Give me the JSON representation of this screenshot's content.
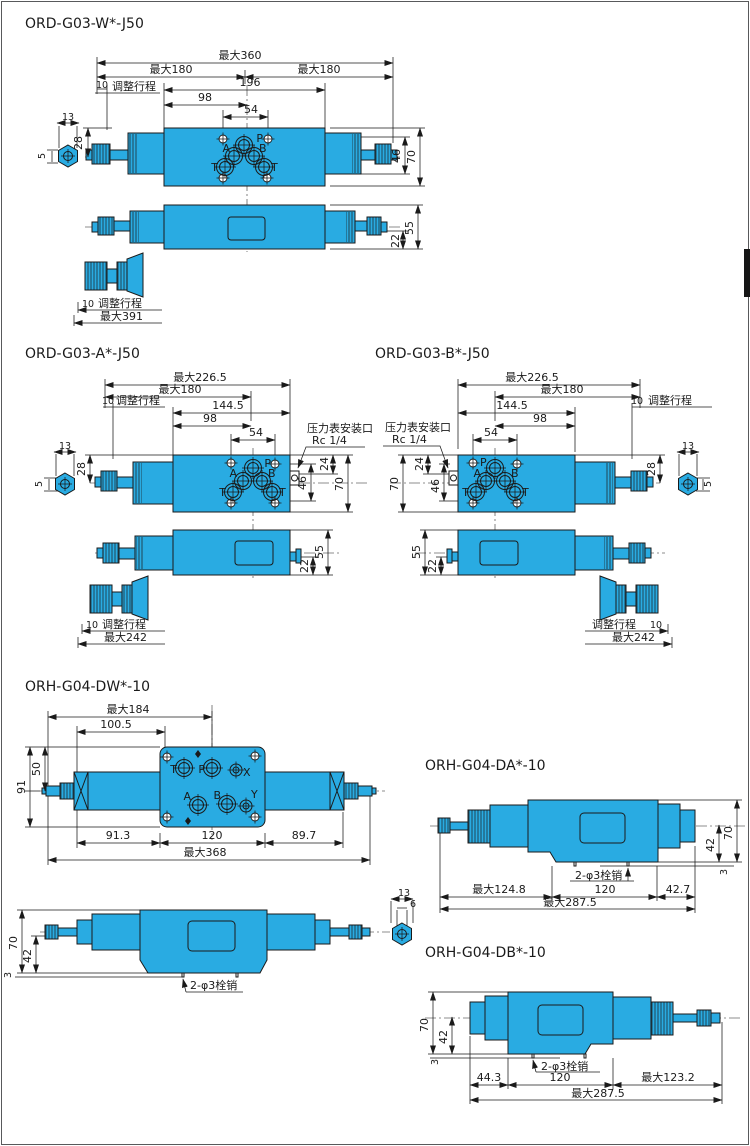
{
  "s1": {
    "title": "ORD-G03-W*-J50",
    "max360": "最大360",
    "max180l": "最大180",
    "max180r": "最大180",
    "d10": "10",
    "stroke": "调整行程",
    "d196": "196",
    "d98": "98",
    "d54": "54",
    "d13": "13",
    "d5": "5",
    "d28": "28",
    "d46": "46",
    "d70": "70",
    "d55": "55",
    "d22": "22",
    "p": "P",
    "a": "A",
    "b": "B",
    "t1": "T",
    "t2": "T",
    "k10": "10",
    "kstroke": "调整行程",
    "kmax": "最大391"
  },
  "s2": {
    "title": "ORD-G03-A*-J50",
    "max2265": "最大226.5",
    "max180": "最大180",
    "d10": "10",
    "stroke": "调整行程",
    "d1445": "144.5",
    "d98": "98",
    "d54": "54",
    "gauge1": "压力表安装口",
    "gauge2": "Rc 1/4",
    "d13": "13",
    "d5": "5",
    "d28": "28",
    "d24": "24",
    "d46": "46",
    "d70": "70",
    "d55": "55",
    "d22": "22",
    "p": "P",
    "a": "A",
    "b": "B",
    "t1": "T",
    "t2": "T",
    "k10": "10",
    "kstroke": "调整行程",
    "kmax": "最大242"
  },
  "s3": {
    "title": "ORD-G03-B*-J50",
    "max2265": "最大226.5",
    "max180": "最大180",
    "d10": "10",
    "stroke": "调整行程",
    "d1445": "144.5",
    "d98": "98",
    "d54": "54",
    "gauge1": "压力表安装口",
    "gauge2": "Rc 1/4",
    "d13": "13",
    "d5": "5",
    "d28": "28",
    "d24": "24",
    "d46": "46",
    "d70": "70",
    "d55": "55",
    "d22": "22",
    "p": "P",
    "a": "A",
    "b": "B",
    "t1": "T",
    "t2": "T",
    "k10": "10",
    "kstroke": "调整行程",
    "kmax": "最大242"
  },
  "s4": {
    "title": "ORH-G04-DW*-10",
    "max184": "最大184",
    "d1005": "100.5",
    "d91": "91",
    "d50": "50",
    "d913": "91.3",
    "d120": "120",
    "d897": "89.7",
    "max368": "最大368",
    "t": "T",
    "p": "P",
    "x": "X",
    "a": "A",
    "b": "B",
    "y": "Y",
    "d70": "70",
    "d42": "42",
    "d3": "3",
    "pins": "2-φ3栓销",
    "d13": "13",
    "d6": "6"
  },
  "s5": {
    "title": "ORH-G04-DA*-10",
    "d70": "70",
    "d42": "42",
    "d3": "3",
    "pins": "2-φ3栓销",
    "max1248": "最大124.8",
    "d120": "120",
    "d427": "42.7",
    "max2875": "最大287.5"
  },
  "s6": {
    "title": "ORH-G04-DB*-10",
    "d70": "70",
    "d42": "42",
    "d3": "3",
    "pins": "2-φ3栓销",
    "d443": "44.3",
    "d120": "120",
    "max1232": "最大123.2",
    "max2875": "最大287.5"
  }
}
